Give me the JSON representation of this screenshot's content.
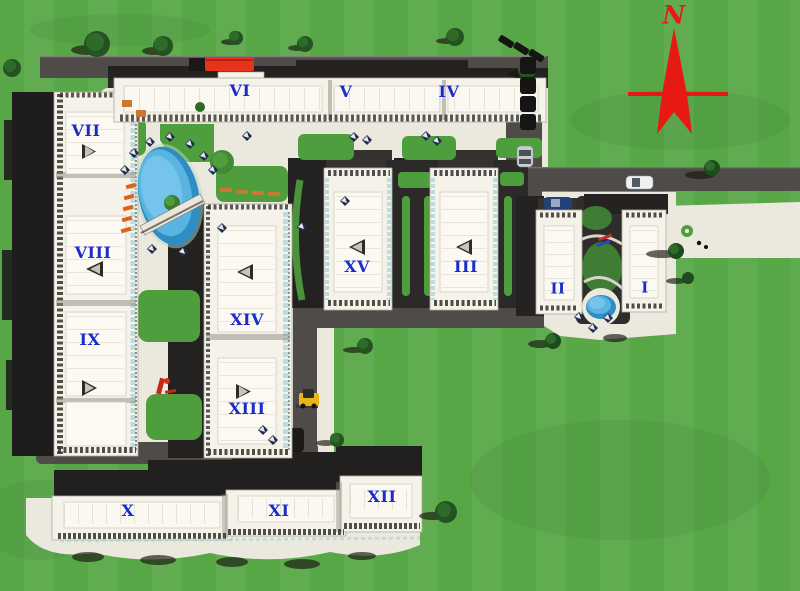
{
  "site_plan": {
    "description": "Aerial masterplan rendering of a residential complex with fifteen numbered apartment buildings, internal roads, two swimming pools, lawns and parked vehicles",
    "north_label": "N"
  },
  "buildings": [
    {
      "id": "building-vii",
      "label": "VII"
    },
    {
      "id": "building-viii",
      "label": "VIII"
    },
    {
      "id": "building-ix",
      "label": "IX"
    },
    {
      "id": "building-vi",
      "label": "VI"
    },
    {
      "id": "building-v",
      "label": "V"
    },
    {
      "id": "building-iv",
      "label": "IV"
    },
    {
      "id": "building-xiv",
      "label": "XIV"
    },
    {
      "id": "building-xiii",
      "label": "XIII"
    },
    {
      "id": "building-xv",
      "label": "XV"
    },
    {
      "id": "building-iii",
      "label": "III"
    },
    {
      "id": "building-ii",
      "label": "II"
    },
    {
      "id": "building-i",
      "label": "I"
    },
    {
      "id": "building-x",
      "label": "X"
    },
    {
      "id": "building-xi",
      "label": "XI"
    },
    {
      "id": "building-xii",
      "label": "XII"
    }
  ],
  "features": {
    "compass": {
      "label": "N",
      "direction": "north"
    },
    "pools": [
      "main-oval-pool-with-bridge",
      "small-round-pool"
    ],
    "vehicles": [
      "red-bus",
      "silver-car",
      "white-car",
      "blue-car",
      "yellow-loader",
      "parked-cars-row"
    ],
    "amenities": [
      "pool-umbrellas",
      "sun-loungers",
      "benches",
      "playground",
      "roundabout-walkway",
      "lawns",
      "trees"
    ]
  },
  "colors": {
    "grass": "#58a747",
    "courtyard_lawn": "#4f9e3e",
    "road": "#4e4b49",
    "pavement": "#ebe8dd",
    "building_roof": "#f4f2e9",
    "shadow": "#232220",
    "pool_water": "#3f9fd4",
    "label_blue": "#1b2cc8",
    "north_red": "#e81812",
    "bus_red": "#e8331c",
    "loader_yellow": "#e8b416"
  }
}
